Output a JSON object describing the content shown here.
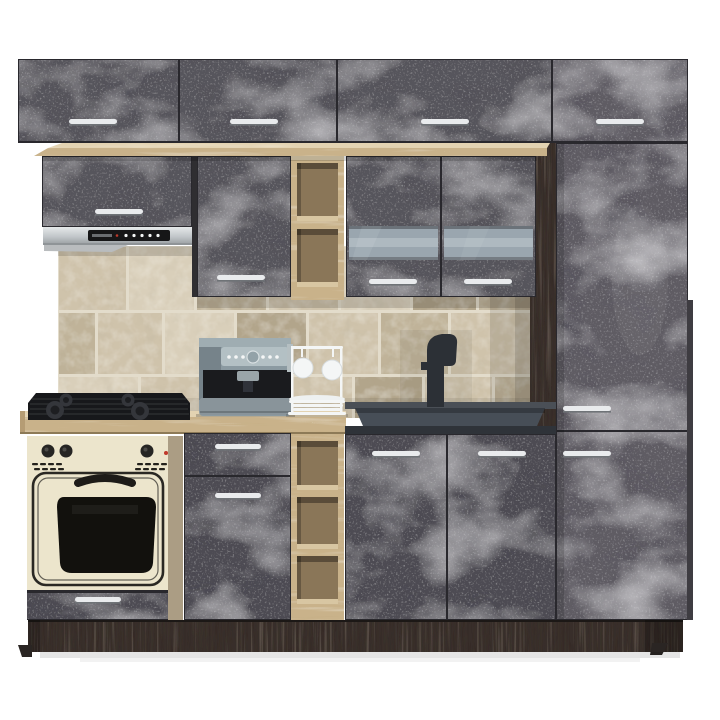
{
  "image": {
    "type": "product-photo",
    "width": 720,
    "height": 720,
    "alt": "Modular kitchen set on white background: dark concrete-effect cabinet fronts with slim chrome handles, sonoma oak shelf board and open shelving columns, stainless extractor hood, frosted-glass wall cabinet, tall pantry column, beige stone tile backsplash, light oak worktop with black gas hob, retro cream built-in oven, grey espresso coffee machine, white mug stand with plates, anthracite sink counter with black designer faucet and dark wenge plinth"
  },
  "scene": {
    "components": [
      {
        "name": "top-cabinet-row",
        "label": "Row of four overhead top-box cabinets"
      },
      {
        "name": "oak-shelf-board",
        "label": "Sonoma oak board under top boxes"
      },
      {
        "name": "hood-cabinet",
        "label": "Short wall cabinet above extractor hood"
      },
      {
        "name": "extractor-hood",
        "label": "Stainless steel extractor hood with black control panel"
      },
      {
        "name": "wall-cabinet-mid",
        "label": "Single-door wall cabinet"
      },
      {
        "name": "open-shelf-upper",
        "label": "Open oak shelf column, two niches"
      },
      {
        "name": "glass-cabinet",
        "label": "Two-door wall cabinet with frosted glass band"
      },
      {
        "name": "tall-cabinet",
        "label": "Tall pantry cabinet column"
      },
      {
        "name": "backsplash",
        "label": "Beige stone tile backsplash"
      },
      {
        "name": "coffee-machine",
        "label": "Grey espresso coffee machine"
      },
      {
        "name": "mug-stand",
        "label": "White mug stand with two mugs and stacked plates"
      },
      {
        "name": "gas-hob",
        "label": "Black four-burner gas hob"
      },
      {
        "name": "countertop-light",
        "label": "Light oak worktop"
      },
      {
        "name": "countertop-sink",
        "label": "Anthracite sink counter with black faucet"
      },
      {
        "name": "oven-unit",
        "label": "Retro cream built-in oven with knobs"
      },
      {
        "name": "base-cabinet-drawer-unit",
        "label": "Base cabinet with drawer and door"
      },
      {
        "name": "open-shelf-lower",
        "label": "Open oak base shelf column, three niches"
      },
      {
        "name": "sink-cabinet",
        "label": "Two-door sink base cabinet"
      },
      {
        "name": "plinth",
        "label": "Dark wenge plinth"
      }
    ],
    "handle_style": "slim horizontal chrome rail",
    "door_handle_count": 15
  },
  "palette": {
    "bg": "#ffffff",
    "concrete_a": "#57555c",
    "concrete_b": "#4e4c53",
    "concrete_c": "#5e5c63",
    "concrete_edge": "#29282d",
    "oak_top": "#e3d3b2",
    "oak_face": "#c9b28a",
    "oak_side": "#b59c74",
    "niche_back": "#8a7658",
    "niche_shelf": "#d8c6a2",
    "wenge": "#372f2b",
    "tile_a": "#cfc3ab",
    "tile_b": "#c0b399",
    "tile_c": "#d9cfba",
    "tile_d": "#b2a58b",
    "grout": "#e3dccb",
    "steel": "#c6cacc",
    "steel_dark": "#8f9497",
    "hood_panel": "#161617",
    "cream": "#ece5cc",
    "oven_dark": "#23211c",
    "oven_window": "#12110d",
    "counter_dark_top": "#4a4f56",
    "basin": "#474e57",
    "counter_dark_face": "#2f3339",
    "faucet": "#2c3036",
    "hob": "#17181b",
    "hob_detail": "#34363b",
    "handle": "#e9ebed",
    "handle_dark": "#6f7377",
    "glass": "#9aa6af",
    "glass_hi": "#c2ccd2",
    "machine_body": "#8b9aa1",
    "machine_panel": "#b3c0c4",
    "machine_dark": "#1a1b1e",
    "machine_base": "#89949a",
    "white": "#f4f6f6"
  }
}
